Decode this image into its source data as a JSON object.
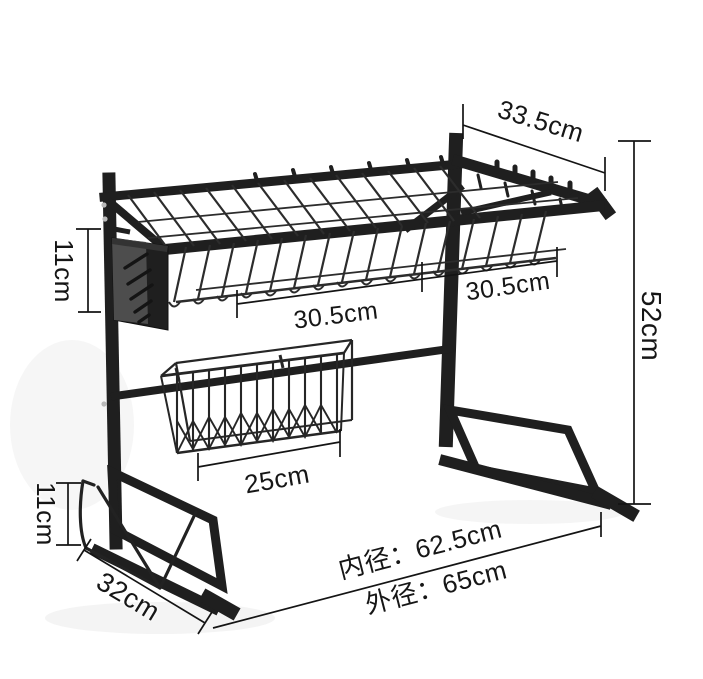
{
  "page": {
    "background": "#ffffff",
    "ink": "#1a1a1a",
    "product_color": "#1f1f1f"
  },
  "annotations": {
    "shelf_depth": "33.5cm",
    "overall_height": "52cm",
    "knife_holder_height": "11cm",
    "left_shelf_width": "30.5cm",
    "right_shelf_width": "30.5cm",
    "basket_width": "25cm",
    "board_holder_height": "11cm",
    "foot_length": "32cm",
    "inner_width": "内径：62.5cm",
    "outer_width": "外径：65cm"
  }
}
